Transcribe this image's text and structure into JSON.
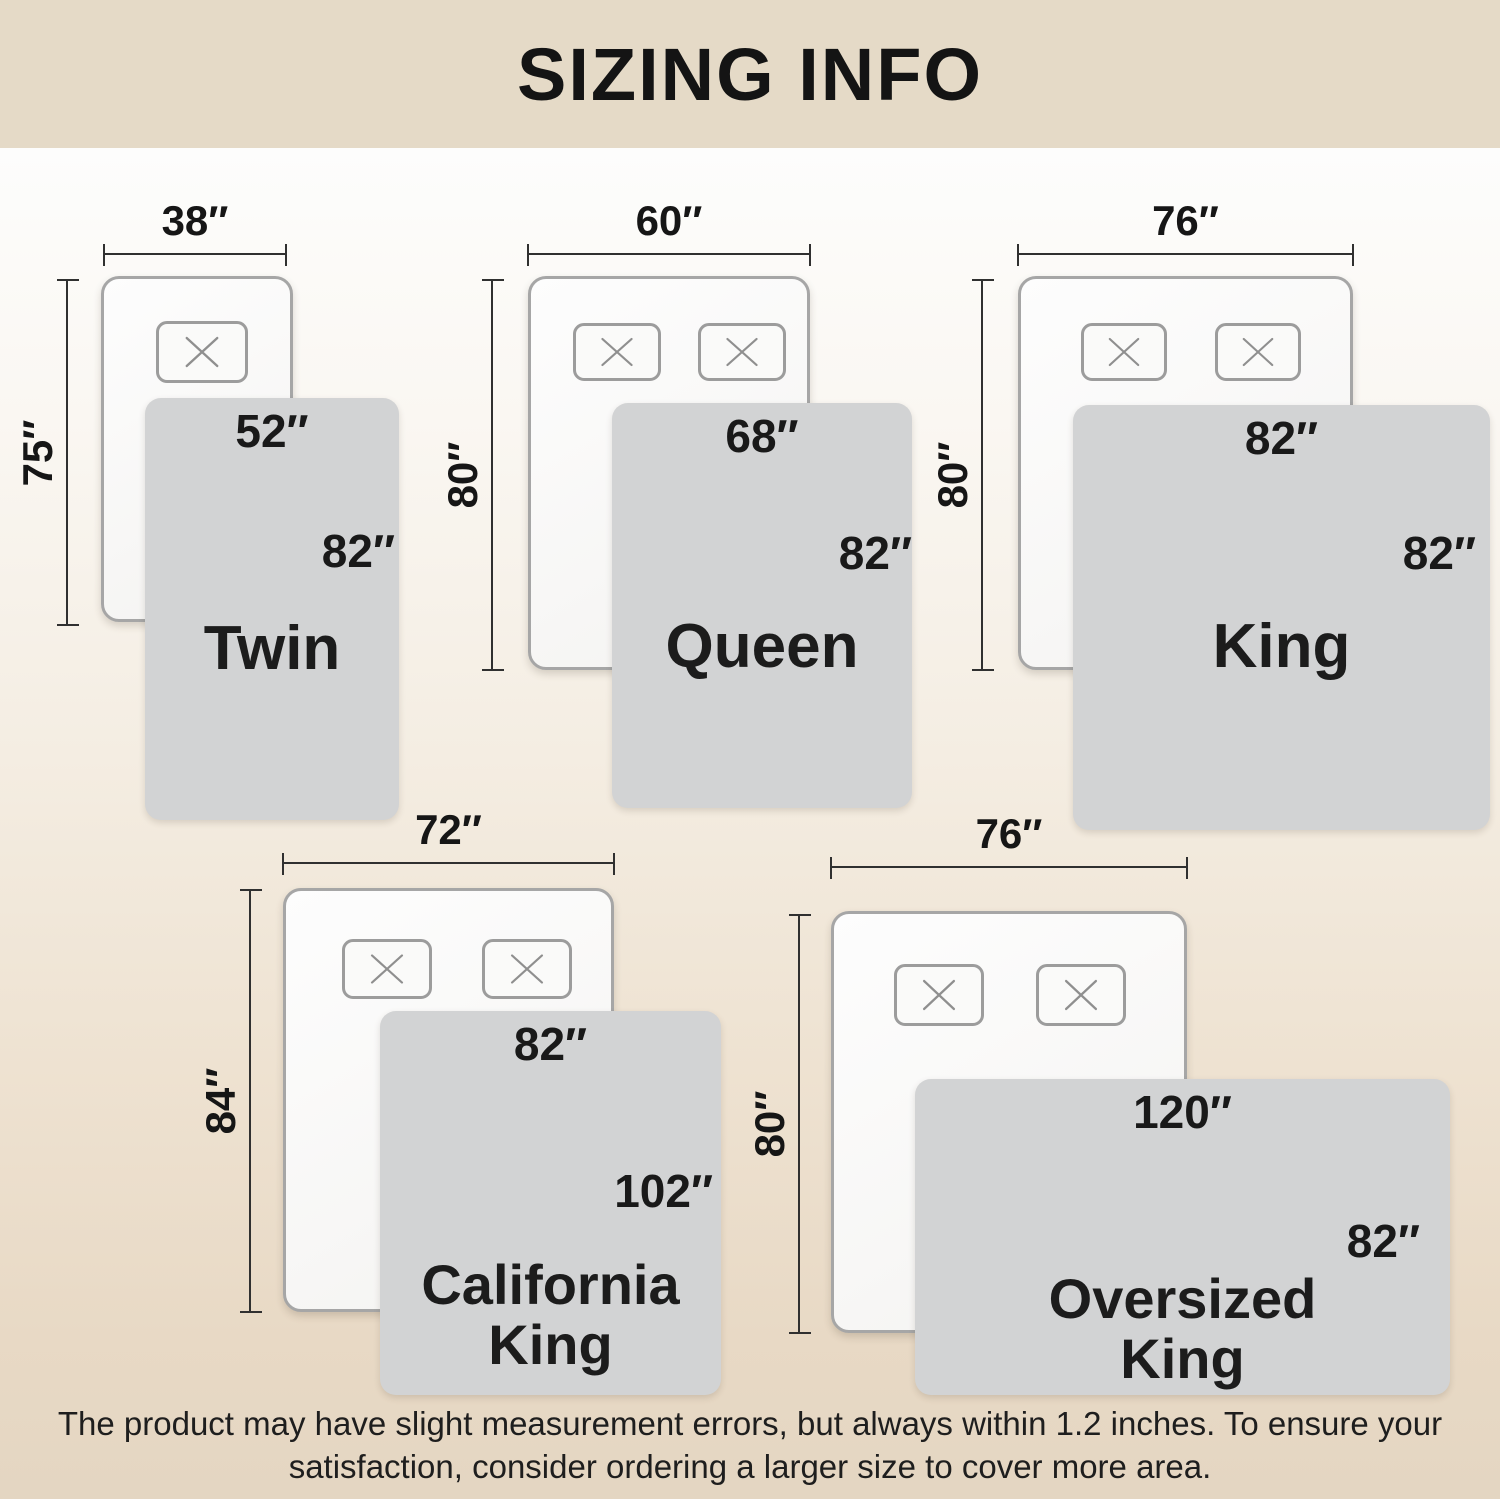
{
  "title": "SIZING INFO",
  "footer": {
    "line1": "The product may have slight measurement errors, but always within 1.2 inches. To ensure your",
    "line2": "satisfaction, consider ordering a larger size to cover more area."
  },
  "sizes": [
    {
      "name": "Twin",
      "bed_width": "38″",
      "bed_length": "75″",
      "blanket_width": "52″",
      "blanket_length": "82″",
      "pillow_count": 1
    },
    {
      "name": "Queen",
      "bed_width": "60″",
      "bed_length": "80″",
      "blanket_width": "68″",
      "blanket_length": "82″",
      "pillow_count": 2
    },
    {
      "name": "King",
      "bed_width": "76″",
      "bed_length": "80″",
      "blanket_width": "82″",
      "blanket_length": "82″",
      "pillow_count": 2
    },
    {
      "name": "California King",
      "bed_width": "72″",
      "bed_length": "84″",
      "blanket_width": "82″",
      "blanket_length": "102″",
      "pillow_count": 2
    },
    {
      "name": "Oversized King",
      "bed_width": "76″",
      "bed_length": "80″",
      "blanket_width": "120″",
      "blanket_length": "82″",
      "pillow_count": 2
    }
  ],
  "colors": {
    "header_band": "#e5dac7",
    "footer_band": "#e4d6c2",
    "background_top": "#fdfdfc",
    "background_bottom": "#e4d6c2",
    "blanket_fill": "#d2d3d4",
    "mattress_border": "#a6a6a6",
    "dimension_line": "#303030",
    "text": "#161616"
  }
}
